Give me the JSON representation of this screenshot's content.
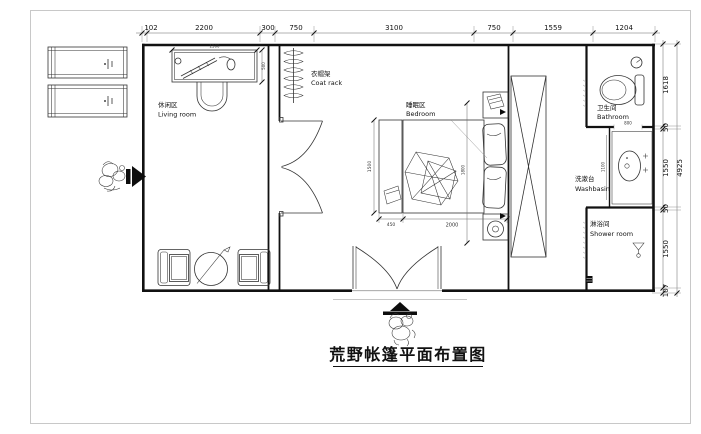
{
  "drawing": {
    "caption": "荒野帐篷平面布置图",
    "rooms": {
      "living": {
        "zh": "休闲区",
        "en": "Living room"
      },
      "coatrack": {
        "zh": "衣帽架",
        "en": "Coat rack"
      },
      "bedroom": {
        "zh": "睡眠区",
        "en": "Bedroom"
      },
      "bathroom": {
        "zh": "卫生间",
        "en": "Bathroom"
      },
      "washbasin": {
        "zh": "洗漱台",
        "en": "Washbasin"
      },
      "shower": {
        "zh": "淋浴间",
        "en": "Shower room"
      }
    },
    "dims_top": [
      "102",
      "2200",
      "300",
      "750",
      "3100",
      "750",
      "1559",
      "1204"
    ],
    "dims_right": [
      "1618",
      "50",
      "1550",
      "50",
      "1550",
      "107"
    ],
    "dims_right_total": "4925",
    "dims_furniture": {
      "desk_width": "1500",
      "desk_depth": "500",
      "bed_width": "1500",
      "bed_length": "2000",
      "bench_depth": "450",
      "bed_zone": "1800",
      "basin_opening": "800",
      "basin_counter": "1100"
    },
    "colors": {
      "line": "#111111",
      "dim": "#666666",
      "page_border": "#c8c8c8"
    }
  }
}
